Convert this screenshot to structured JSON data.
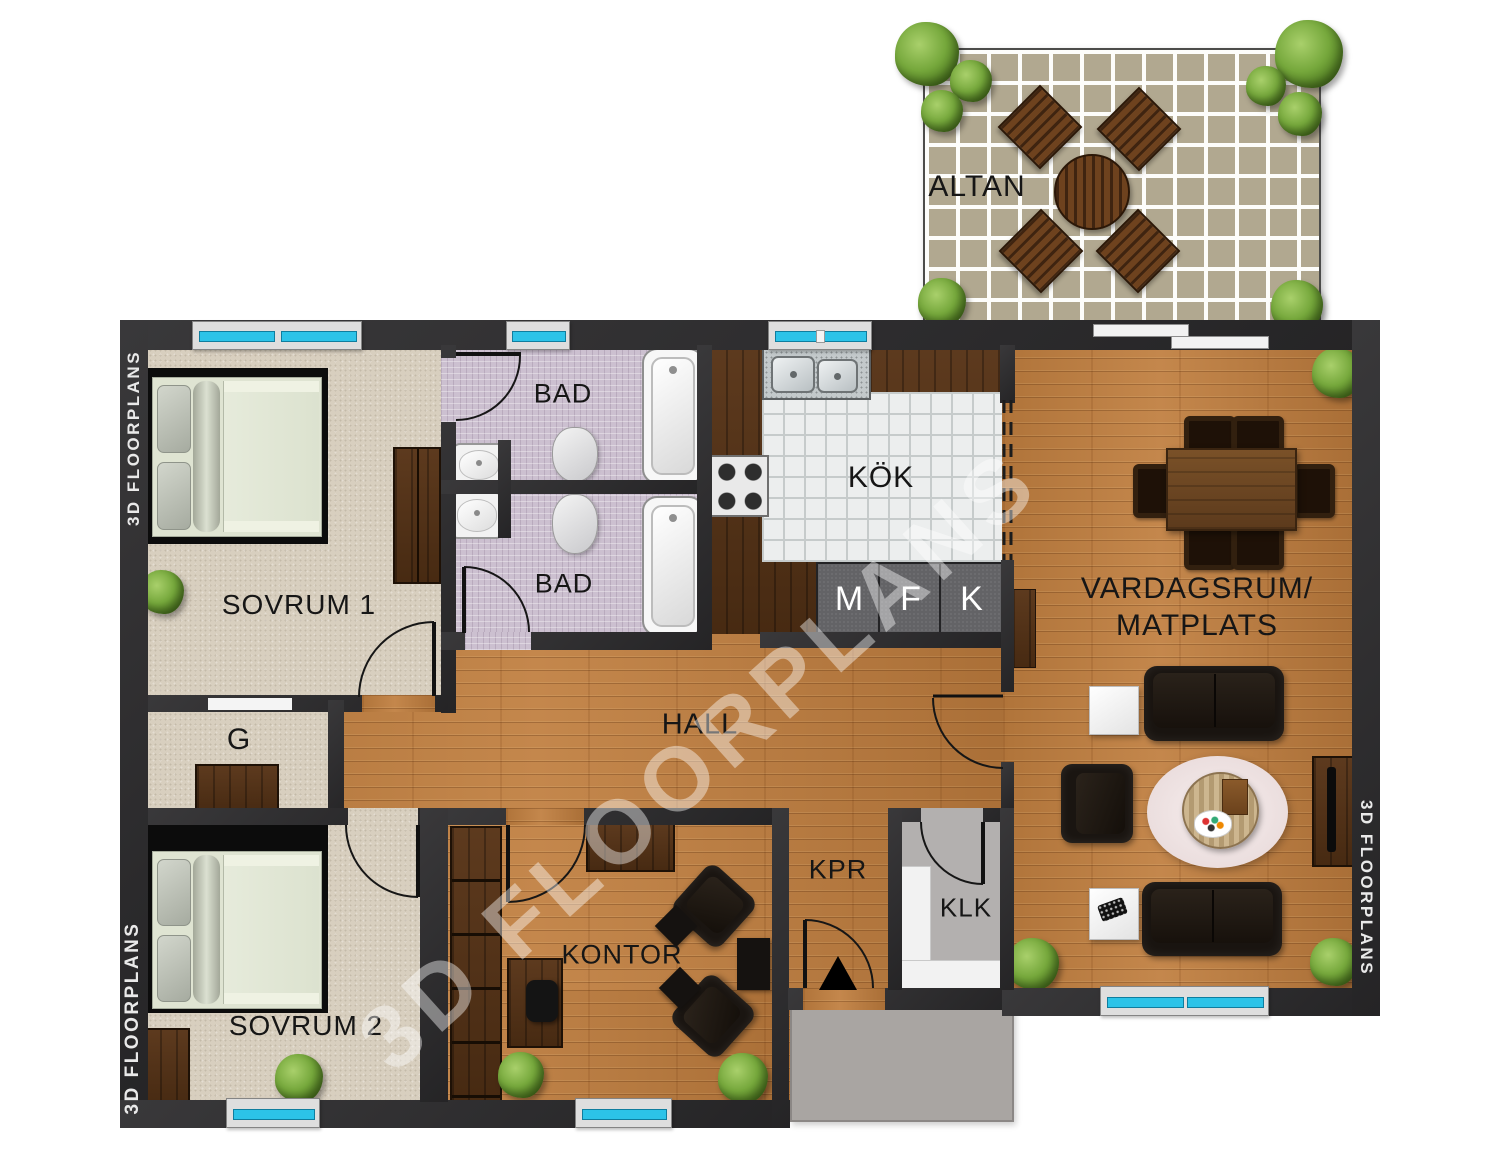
{
  "title": "3D FLOORPLANS apartment floor plan",
  "watermark": "3D FLOORPLANS",
  "edge_label": "3D FLOORPLANS",
  "rooms": {
    "altan": {
      "label": "ALTAN"
    },
    "sovrum1": {
      "label": "SOVRUM 1"
    },
    "sovrum2": {
      "label": "SOVRUM 2"
    },
    "bad1": {
      "label": "BAD"
    },
    "bad2": {
      "label": "BAD"
    },
    "kok": {
      "label": "KÖK"
    },
    "hall": {
      "label": "HALL"
    },
    "kontor": {
      "label": "KONTOR"
    },
    "kpr": {
      "label": "KPR"
    },
    "klk": {
      "label": "KLK"
    },
    "garderob": {
      "label": "G"
    },
    "vardagsrum": {
      "label_line1": "VARDAGSRUM/",
      "label_line2": "MATPLATS"
    }
  },
  "appliances": [
    {
      "label": "M"
    },
    {
      "label": "F"
    },
    {
      "label": "K"
    }
  ],
  "colors": {
    "wall": "#2d2c2e",
    "wood_floor": "#b5793e",
    "dark_wood": "#55321a",
    "carpet": "#d8cfbf",
    "bath_tile": "#ccc0d0",
    "kitchen_tile": "#eceeee",
    "altan_tile": "#b1a890",
    "window_glass": "#2cc3e8",
    "entry_pad": "#a9a5a2",
    "sofa_black": "#191410"
  }
}
